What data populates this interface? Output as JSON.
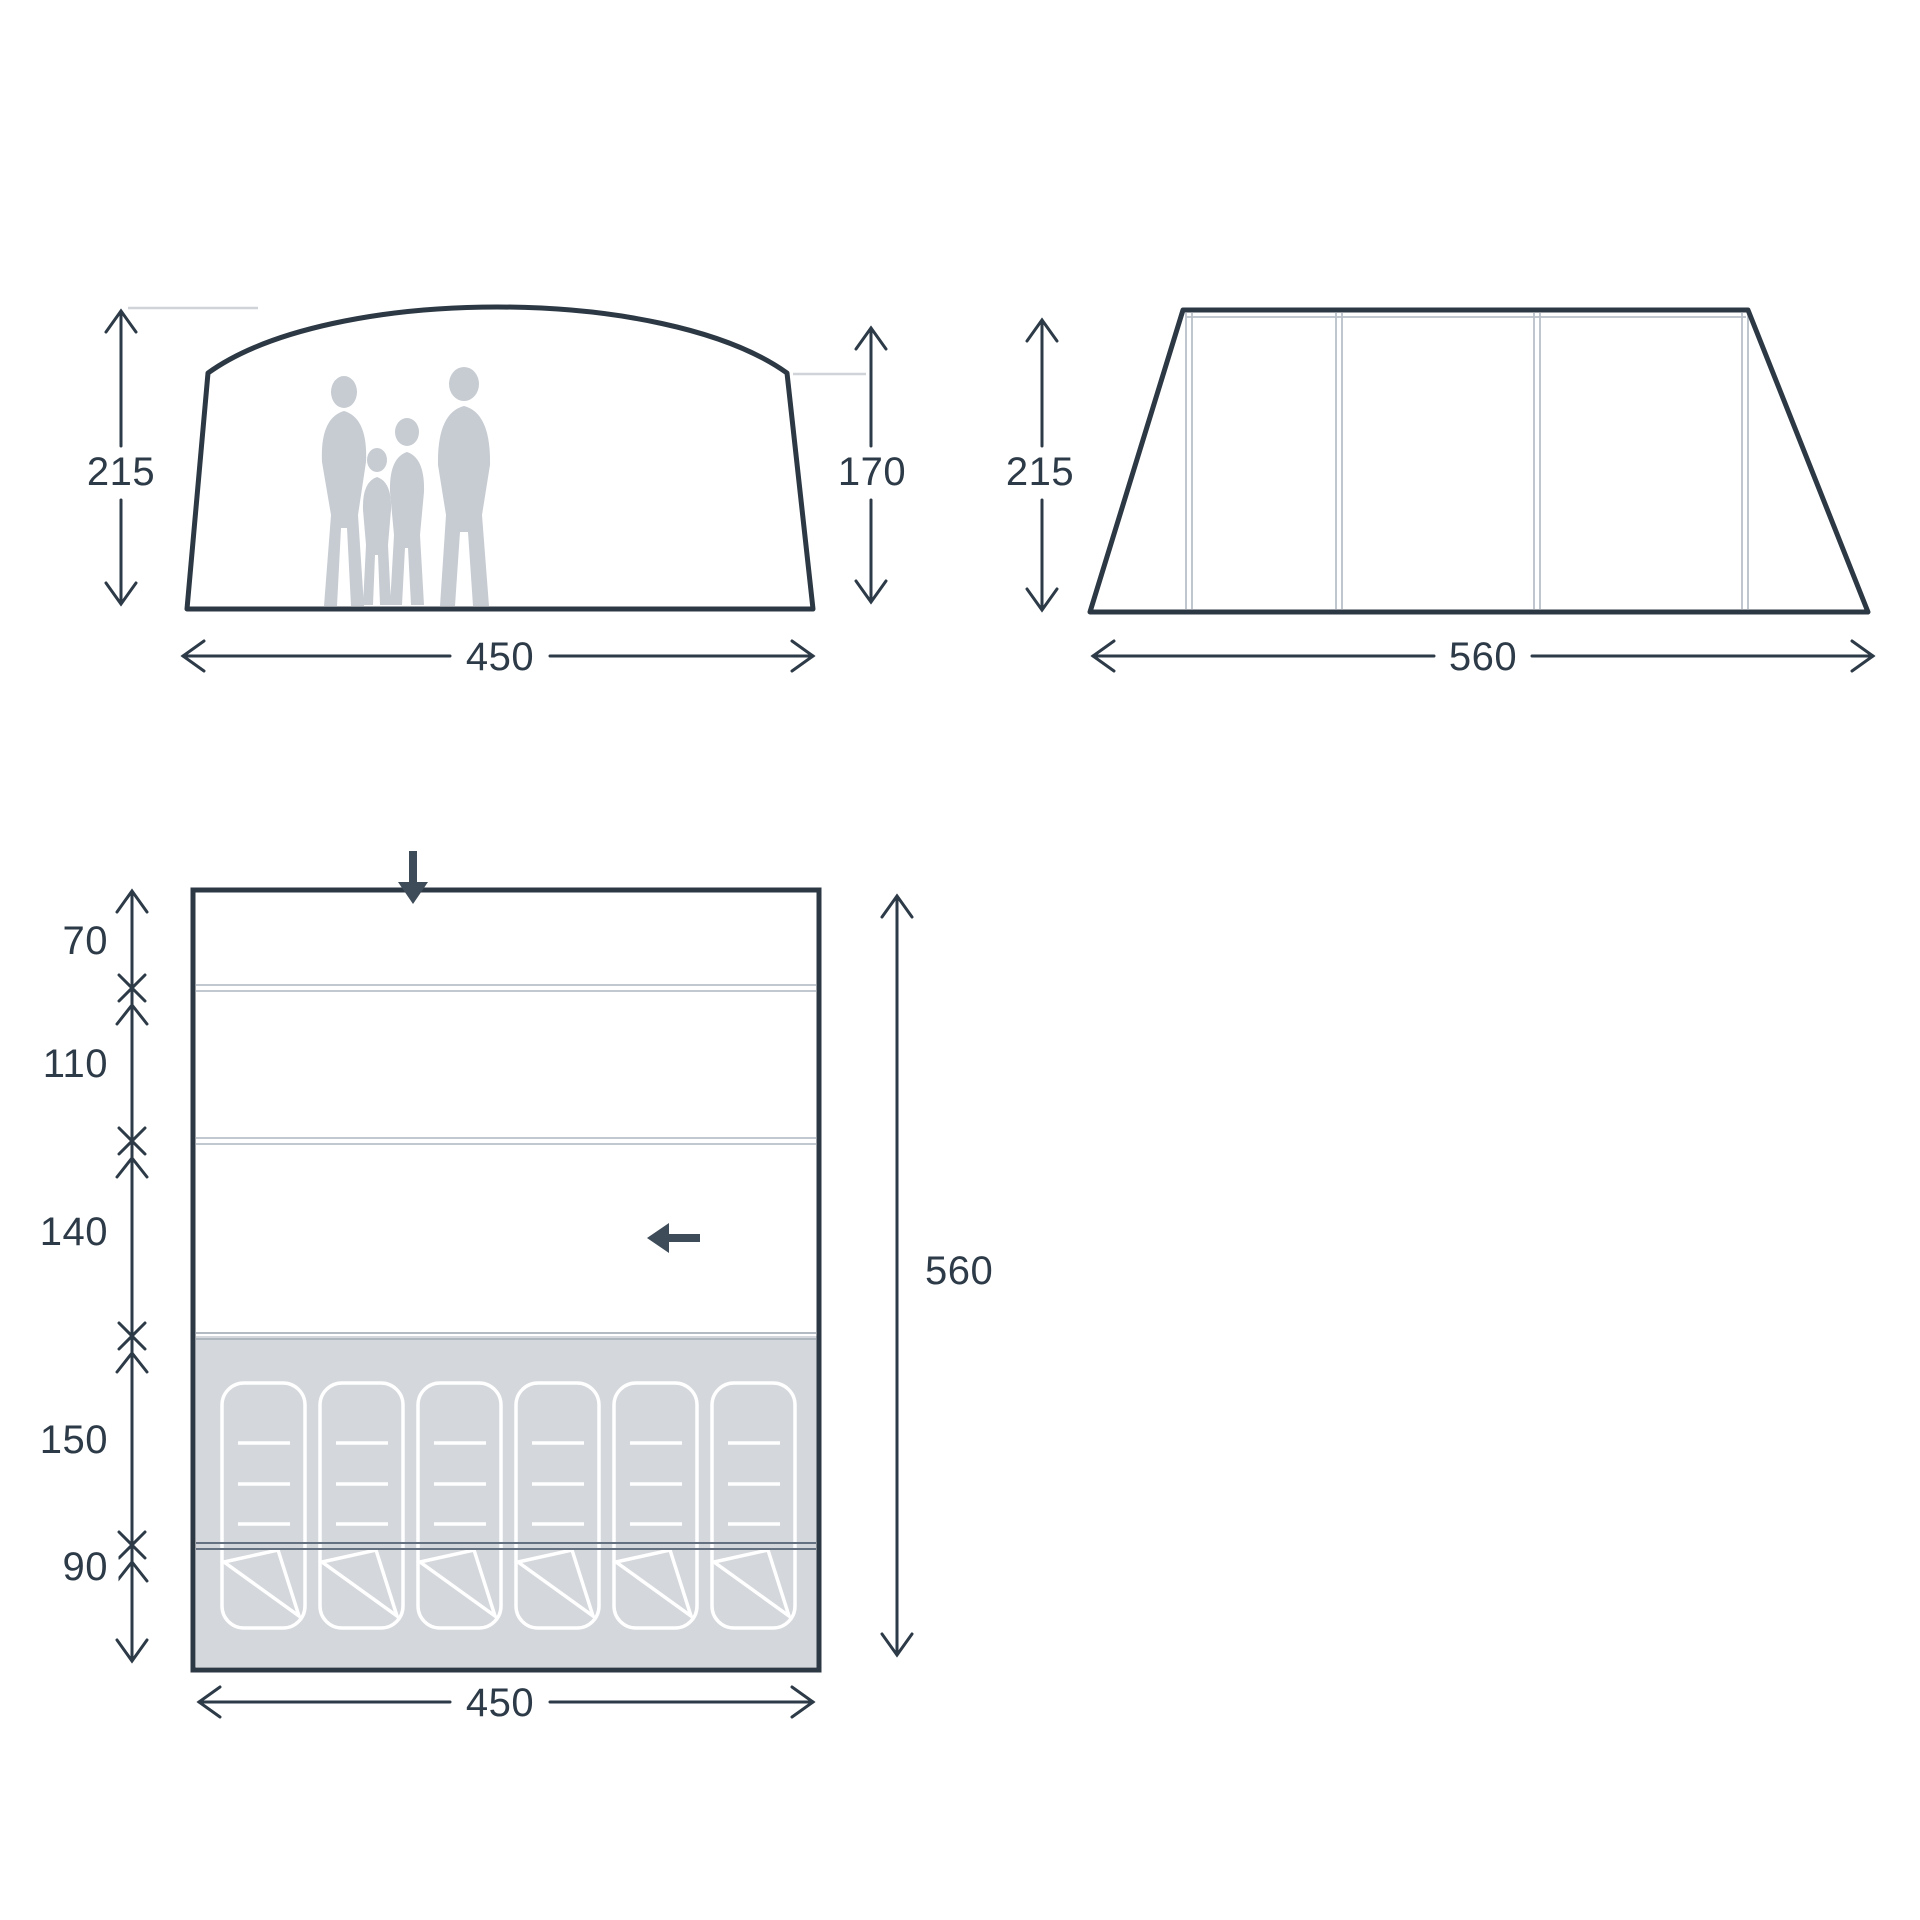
{
  "diagram": {
    "type": "tent-dimension-diagram",
    "units": "cm"
  },
  "front_view": {
    "name": "front elevation",
    "peak_height": "215",
    "wall_height": "170",
    "width": "450"
  },
  "side_view": {
    "name": "side elevation",
    "height": "215",
    "length": "560"
  },
  "floor_plan": {
    "name": "floor plan",
    "rooms": [
      {
        "depth": "70"
      },
      {
        "depth": "110"
      },
      {
        "depth": "140"
      },
      {
        "depth": "150"
      },
      {
        "depth": "90"
      }
    ],
    "total_length": "560",
    "width": "450",
    "sleeping_pads_count": 6
  },
  "icons": {
    "front_entrance_arrow": "arrow-down",
    "side_entrance_arrow": "arrow-left"
  },
  "colors": {
    "ink": "#2c3844",
    "text": "#2d3a47",
    "silhouette": "#c7ccd3",
    "floor_gray": "#d4d7db",
    "seam_light": "#b9c0c8",
    "partition_dark": "#657080",
    "reference_line": "#d0d4d9",
    "entrance_arrow": "#3e4b59",
    "background": "#ffffff"
  }
}
